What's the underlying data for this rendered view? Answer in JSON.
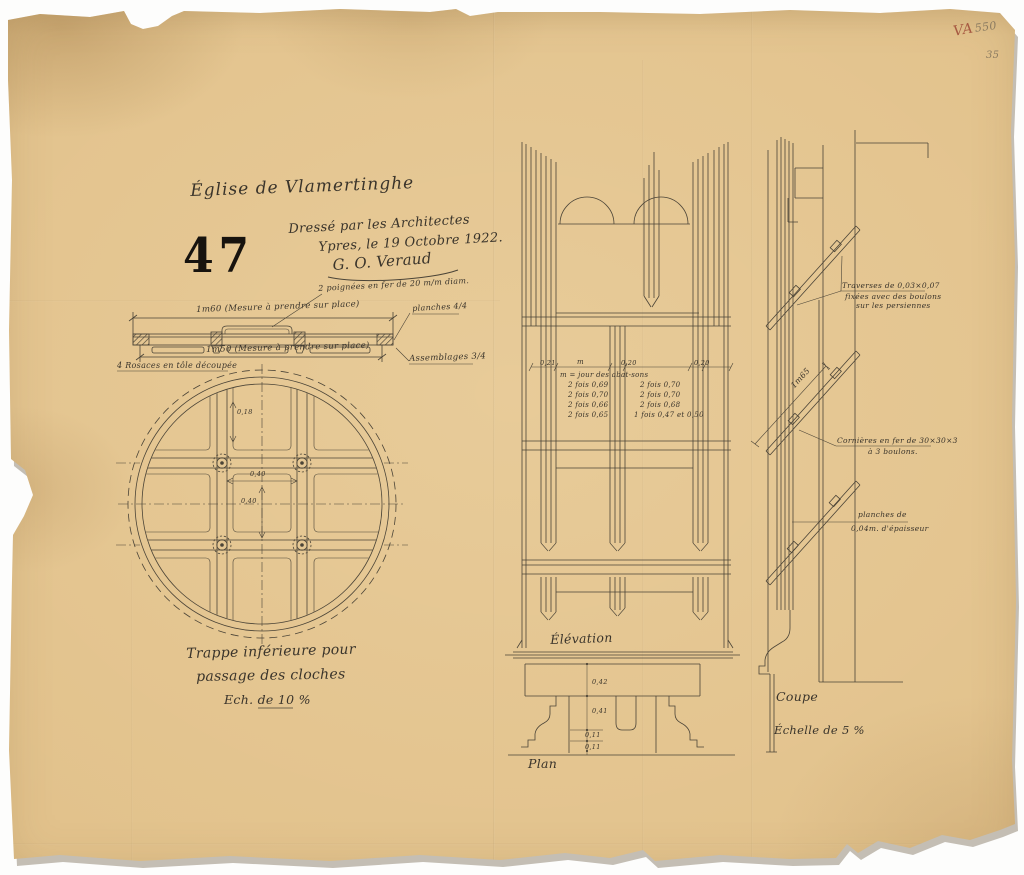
{
  "document": {
    "title": "Église de Vlamertinghe",
    "sheet_number": "47",
    "credit_line1": "Dressé par les Architectes",
    "credit_line2": "Ypres, le 19 Octobre 1922.",
    "signature": "G. O. Veraud",
    "corner_mark_red": "VA",
    "corner_mark_pencil": "550",
    "corner_mark_pencil2": "35"
  },
  "detail_section": {
    "ann_handles": "2 poignées en fer de 20 m/m diam.",
    "dim_top": "1m60 (Mesure à prendre sur place)",
    "dim_bottom": "1m50 (Mesure à prendre sur place)",
    "ann_rosaces": "4 Rosaces en tôle découpée",
    "ann_planches": "planches 4/4",
    "ann_assemblages": "Assemblages 3/4"
  },
  "trap_plan": {
    "dim_small": "0,18",
    "dim_w": "0,40",
    "dim_h": "0,40",
    "caption1": "Trappe inférieure pour",
    "caption2": "passage des cloches",
    "caption3": "Ech. de 10 %"
  },
  "elevation": {
    "dim_0": "0,21",
    "dim_m": "m",
    "dim_1": "0,20",
    "dim_2": "0,20",
    "note_title": "m = jour des abat-sons",
    "col_left": [
      "2 fois 0,69",
      "2 fois 0,70",
      "2 fois 0,66",
      "2 fois 0,65"
    ],
    "col_right": [
      "2 fois 0,70",
      "2 fois 0,70",
      "2 fois 0,68",
      "1 fois 0,47 et 0,50"
    ],
    "label": "Élévation"
  },
  "plan": {
    "d1": "0,42",
    "d2": "0,41",
    "d3": "0,11",
    "d4": "0,11",
    "label": "Plan"
  },
  "coupe": {
    "dim_diag": "1m65",
    "traverses1": "Traverses de 0,03×0,07",
    "traverses2": "fixées avec des boulons",
    "traverses3": "sur les persiennes",
    "cornieres1": "Cornières en fer de 30×30×3",
    "cornieres2": "à 3 boulons.",
    "planches1": "planches de",
    "planches2": "0,04m. d'épaisseur",
    "label": "Coupe",
    "scale": "Échelle de 5 %"
  },
  "colors": {
    "paper": "#e2c28c",
    "ink": "#3a342b",
    "stamp": "#17130e",
    "red_mark": "#a75a42",
    "pencil": "#8b7b61"
  }
}
